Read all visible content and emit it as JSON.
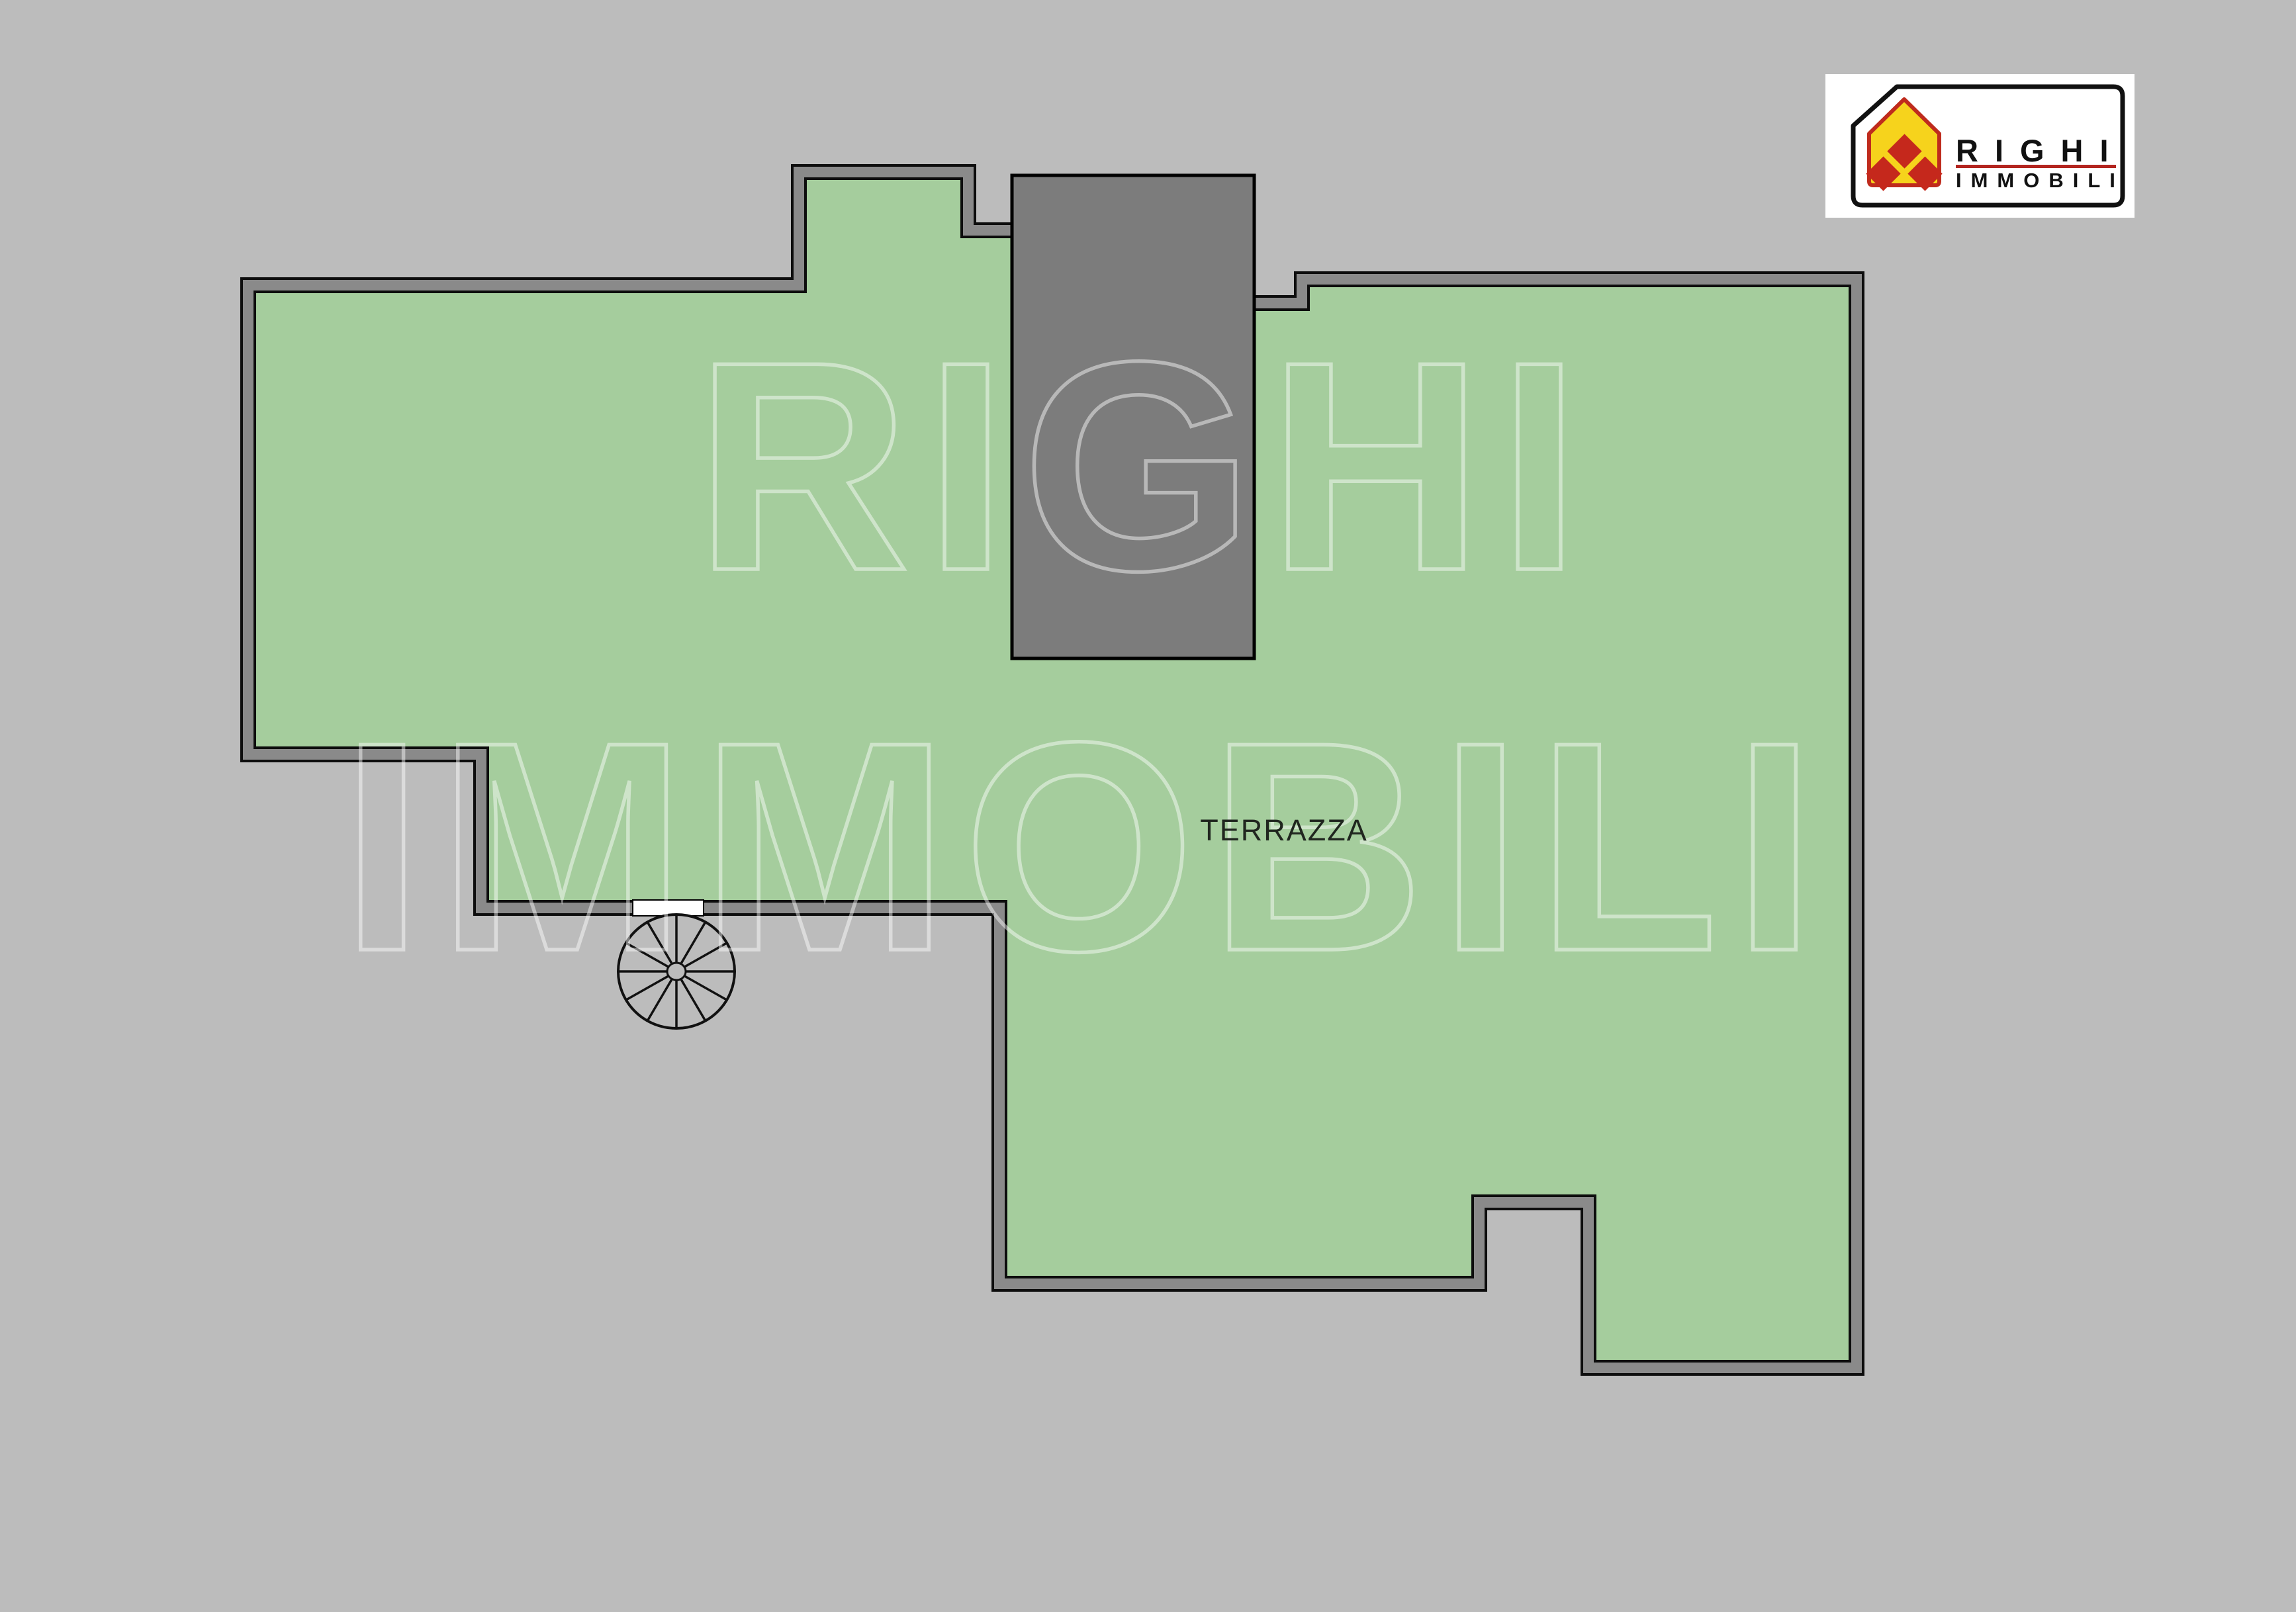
{
  "plan": {
    "room_label": "TERRAZZA",
    "type": "terrace floor plan"
  },
  "watermark": {
    "line1": "RIGHI",
    "line2": "IMMOBILI"
  },
  "logo": {
    "name": "RIGHI",
    "subtitle": "IMMOBILI"
  },
  "colors": {
    "background": "#bcbcbc",
    "terrace_fill": "#a5cd9d",
    "wall_band": "#8a8a8a",
    "wall_line": "#0d0d0d",
    "stairwell_fill": "#7c7c7c",
    "door_opening": "#ffffff",
    "label_text": "#20261f",
    "watermark_stroke": "rgba(255,255,255,0.46)",
    "logo_house_yellow": "#f6d31c",
    "logo_house_red": "#bf2b1d",
    "logo_underline_red": "#b3251f",
    "logo_text_black": "#111111"
  }
}
